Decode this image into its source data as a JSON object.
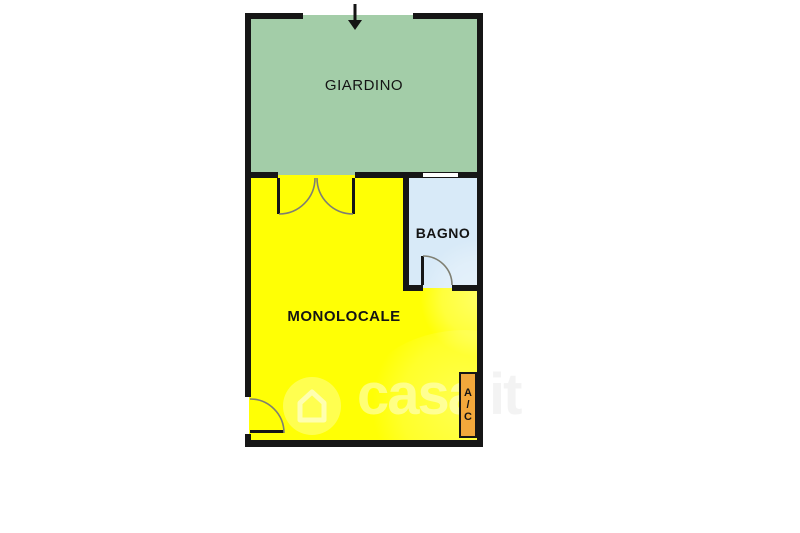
{
  "floorplan": {
    "type": "apartment-floor-plan",
    "rooms": {
      "garden": {
        "label": "GIARDINO",
        "color": "#a3cda8"
      },
      "studio": {
        "label": "MONOLOCALE",
        "color": "#ffff05"
      },
      "bathroom": {
        "label": "BAGNO",
        "color": "#d8eaf8"
      },
      "ac_unit": {
        "label": "A/C",
        "label_chars": [
          "A",
          "/",
          "C"
        ],
        "color": "#f2a83b"
      }
    },
    "wall_color": "#161616",
    "features": [
      "north-entrance-arrow",
      "garden-french-doors",
      "bathroom-window",
      "bathroom-door",
      "entry-door"
    ]
  },
  "watermark": {
    "brand": "casa",
    "suffix": "it"
  }
}
